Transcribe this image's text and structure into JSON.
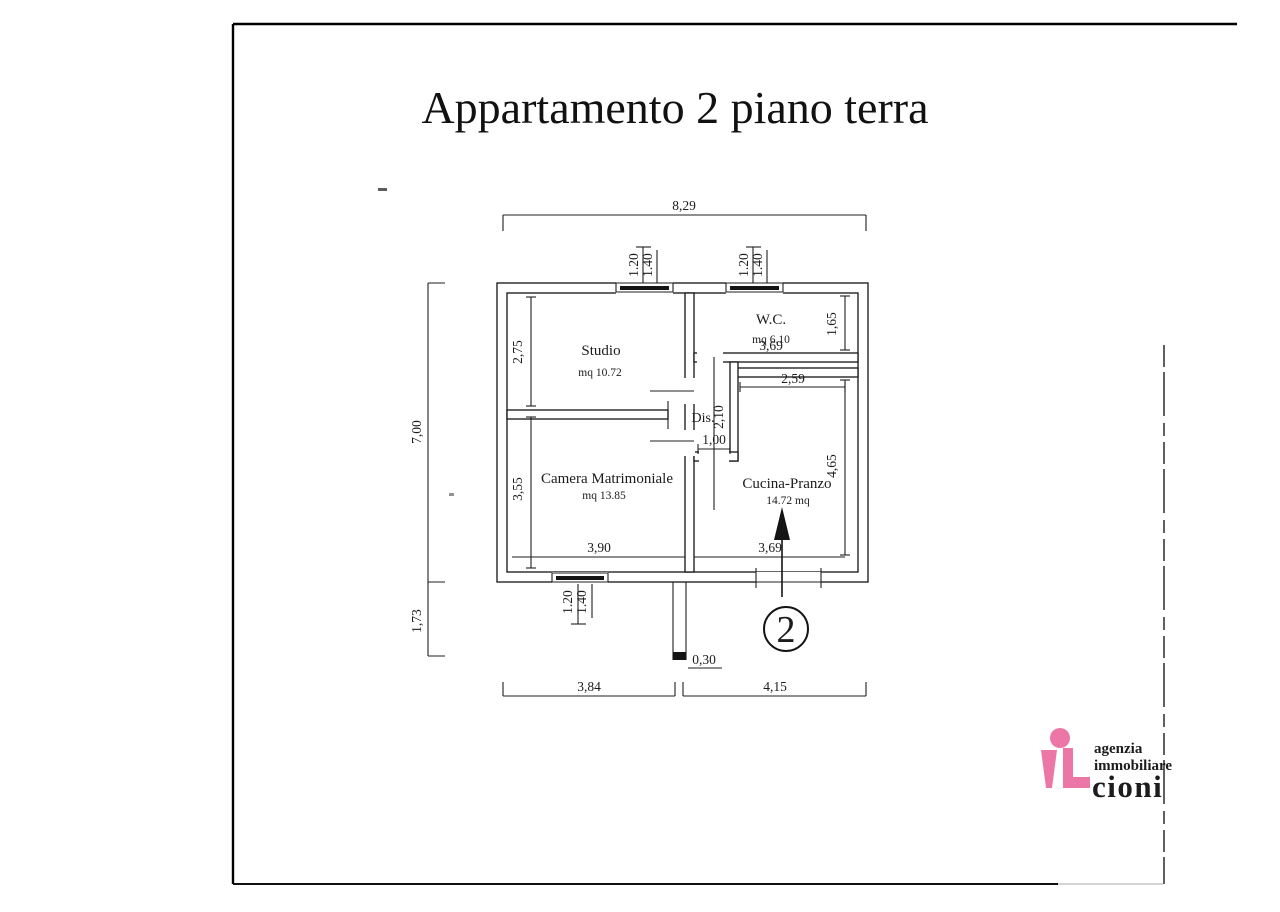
{
  "title": "Appartamento 2 piano terra",
  "plan": {
    "unit_number": "2",
    "rooms": {
      "studio": {
        "name": "Studio",
        "area": "mq 10.72"
      },
      "wc": {
        "name": "W.C.",
        "area": "mq 6.10"
      },
      "dis": {
        "name": "Dis."
      },
      "camera": {
        "name": "Camera Matrimoniale",
        "area": "mq 13.85"
      },
      "cucina": {
        "name": "Cucina-Pranzo",
        "area": "14.72 mq"
      }
    },
    "dims": {
      "overall_width": "8,29",
      "overall_height": "7,00",
      "below_height": "1,73",
      "window_inner": "1.20",
      "window_outer": "1.40",
      "studio_height": "2,75",
      "camera_height": "3,55",
      "wc_height": "1,65",
      "cucina_height": "4,65",
      "wc_width": "3,69",
      "cucina_top_width": "2,59",
      "dis_height": "2,10",
      "dis_passage": "1,00",
      "camera_width": "3,90",
      "cucina_width": "3,69",
      "entry_wall_thickness": "0,30",
      "bottom_left_width": "3,84",
      "bottom_right_width": "4,15"
    }
  },
  "logo": {
    "line1": "agenzia",
    "line2": "immobiliare",
    "brand": "cioni",
    "pink": "#ec77a7",
    "blue": "#2b5ca8"
  }
}
